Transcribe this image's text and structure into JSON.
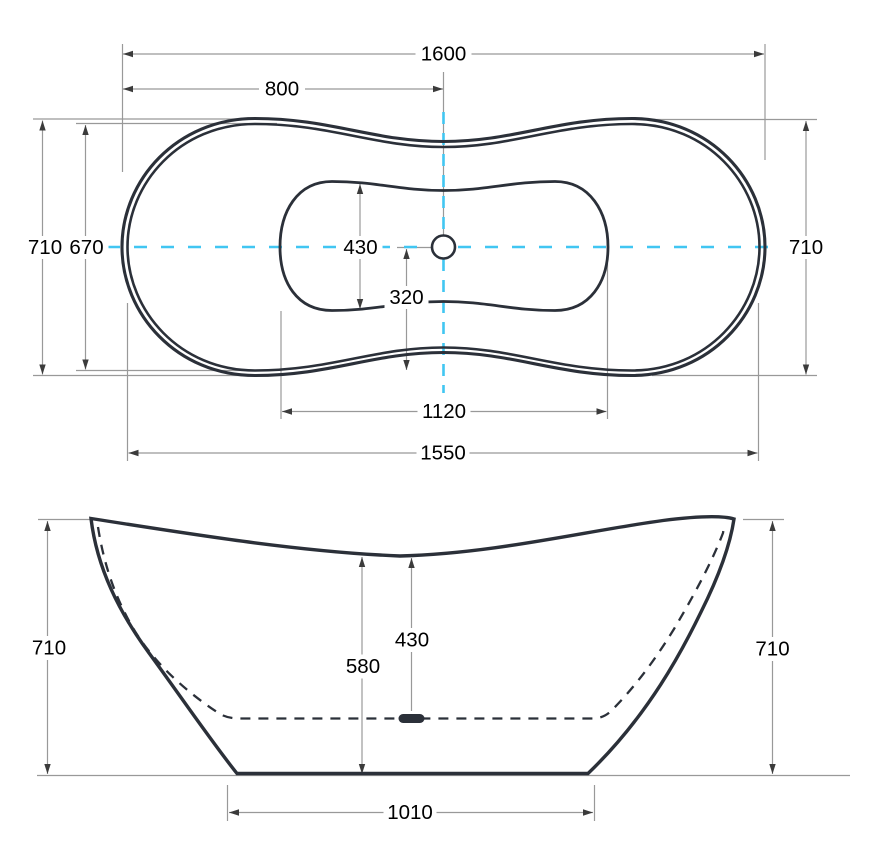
{
  "views": {
    "top": {
      "overall_length": "1600",
      "center_to_end": "800",
      "overall_width": "710",
      "inner_rim_width": "670",
      "overall_width_right": "710",
      "basin_width": "430",
      "drain_to_edge": "320",
      "basin_length": "1120",
      "rim_length": "1550"
    },
    "front": {
      "overall_height": "710",
      "rim_to_drain_depth": "430",
      "inner_height": "580",
      "overall_height_right": "710",
      "base_length": "1010"
    }
  },
  "colors": {
    "outline": "#2b3039",
    "dimension_lines": "#999999",
    "centerline": "#41c6f2",
    "label_text": "#000000",
    "background": "#ffffff"
  }
}
